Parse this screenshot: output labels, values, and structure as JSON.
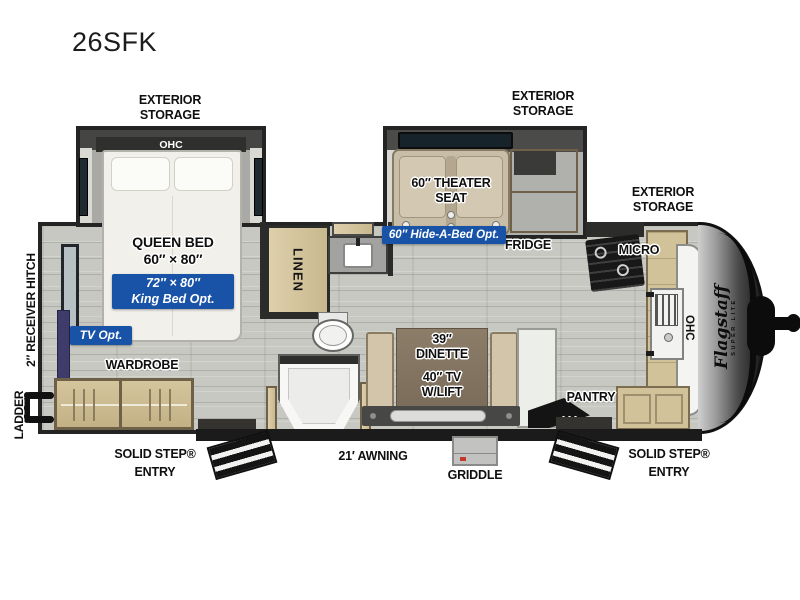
{
  "title": "26SFK",
  "front_cap": {
    "brand": "Flagstaff",
    "brand_sub": "SUPER LITE"
  },
  "exterior": {
    "storage": "EXTERIOR STORAGE",
    "receiver_hitch": "2″ RECEIVER HITCH",
    "ladder": "LADDER",
    "awning": "21′ AWNING",
    "griddle": "GRIDDLE",
    "solid_step_entry": "SOLID STEP® ENTRY"
  },
  "bedroom": {
    "ohc": "OHC",
    "bed_name": "QUEEN BED",
    "bed_size": "60″ × 80″",
    "king_opt_size": "72″ × 80″",
    "king_opt_label": "King Bed Opt.",
    "tv_opt": "TV Opt.",
    "wardrobe": "WARDROBE"
  },
  "bathroom": {
    "linen": "LINEN"
  },
  "living": {
    "theater_line1": "60″ THEATER",
    "theater_line2": "SEAT",
    "hide_a_bed_opt": "60″ Hide-A-Bed Opt.",
    "dinette_size": "39″",
    "dinette": "DINETTE",
    "tv_lift_line1": "40″ TV",
    "tv_lift_line2": "W/LIFT"
  },
  "kitchen": {
    "fridge": "FRIDGE",
    "micro": "MICRO",
    "pantry": "PANTRY",
    "ohc": "OHC"
  },
  "colors": {
    "badge_blue": "#1853a8",
    "wall": "#242424",
    "floor": "#c8cac3",
    "wood": "#d2c29c",
    "tv_accent": "#3f3c6b"
  }
}
